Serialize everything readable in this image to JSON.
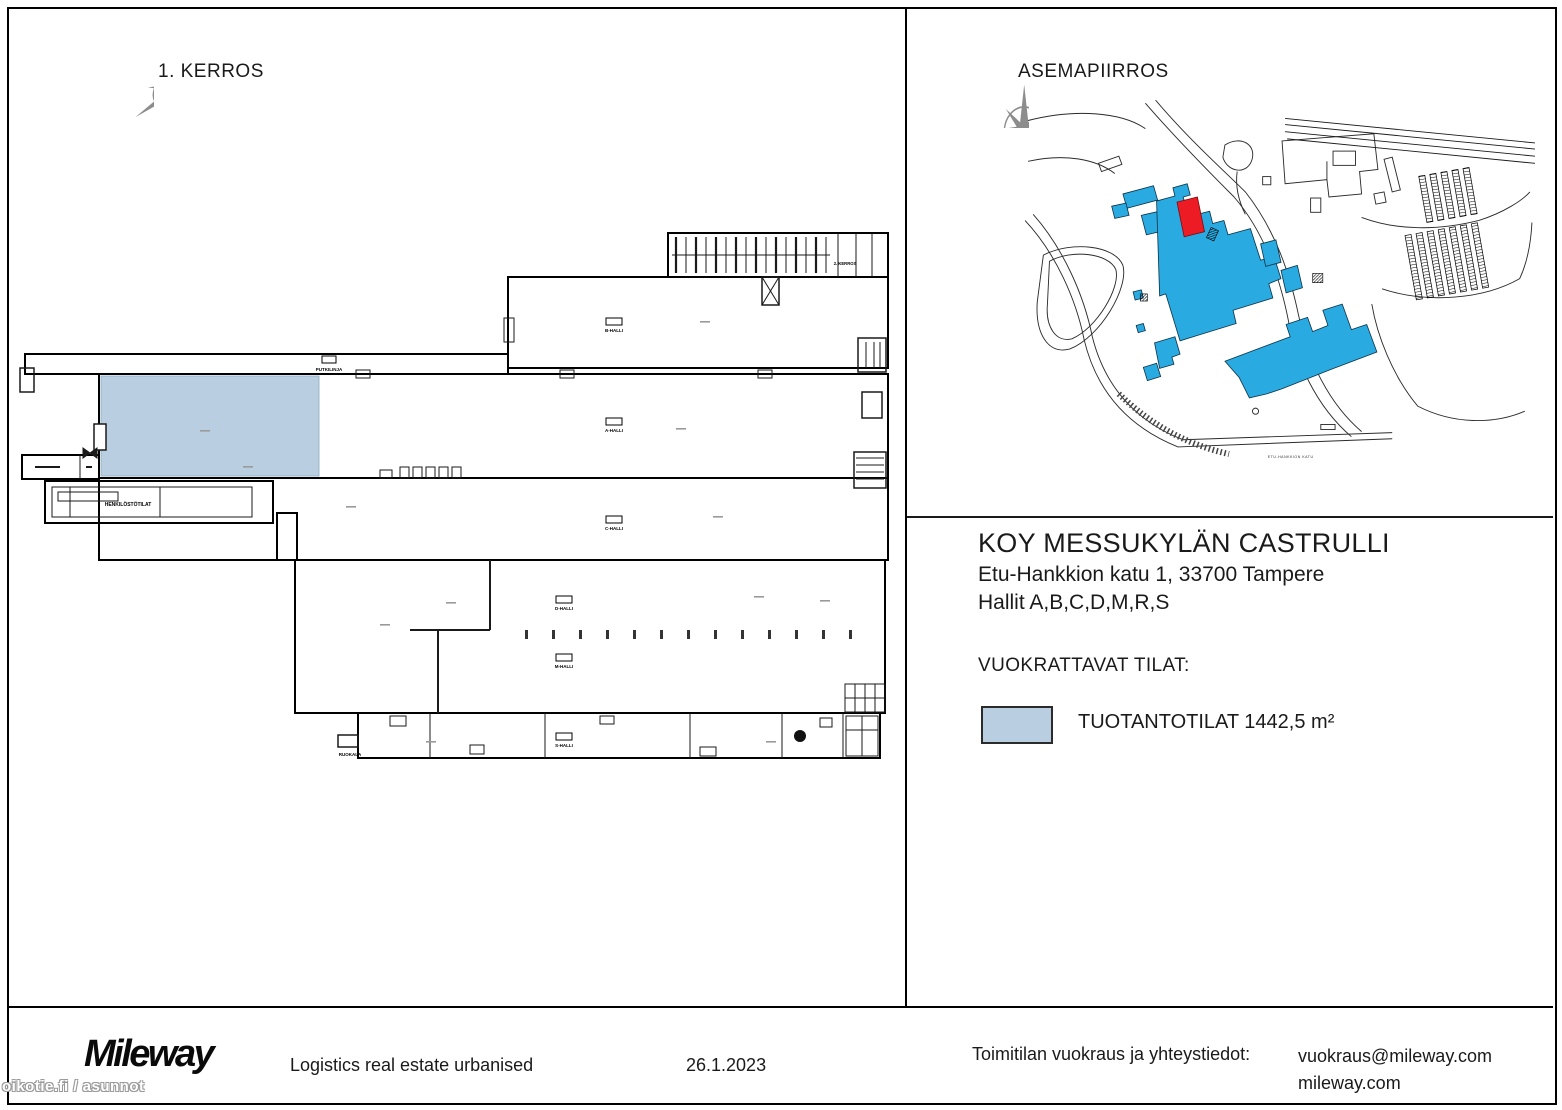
{
  "floor_plan": {
    "title": "1. KERROS",
    "highlight_color": "#b9cfe1",
    "hall_labels": [
      {
        "text": "B-HALLI"
      },
      {
        "text": "A-HALLI"
      },
      {
        "text": "C-HALLI"
      },
      {
        "text": "D-HALLI"
      },
      {
        "text": "M-HALLI"
      },
      {
        "text": "S-HALLI"
      }
    ],
    "small_labels": {
      "pipeline": "PUTKILINJA",
      "staff": "HENKILÖSTÖTILAT",
      "canteen": "RUOKALA",
      "office": "2. KERROS"
    }
  },
  "site_plan": {
    "title": "ASEMAPIIRROS",
    "street_label": "ETU-HANKKION KATU",
    "building_color": "#29abe2",
    "highlight_color": "#ed1c24"
  },
  "property": {
    "name": "KOY MESSUKYLÄN CASTRULLI",
    "address": "Etu-Hankkion katu 1, 33700 Tampere",
    "halls": "Hallit A,B,C,D,M,R,S"
  },
  "legend": {
    "heading": "VUOKRATTAVAT TILAT:",
    "swatch_color": "#b9cfe1",
    "label": "TUOTANTOTILAT 1442,5 m²"
  },
  "footer": {
    "logo": "Mileway",
    "tagline": "Logistics real estate urbanised",
    "date": "26.1.2023",
    "contact_heading": "Toimitilan vuokraus ja yhteystiedot:",
    "contact_line1": "vuokraus@mileway.com",
    "contact_line2": "mileway.com"
  },
  "watermark": "oikotie.fi / asunnot"
}
